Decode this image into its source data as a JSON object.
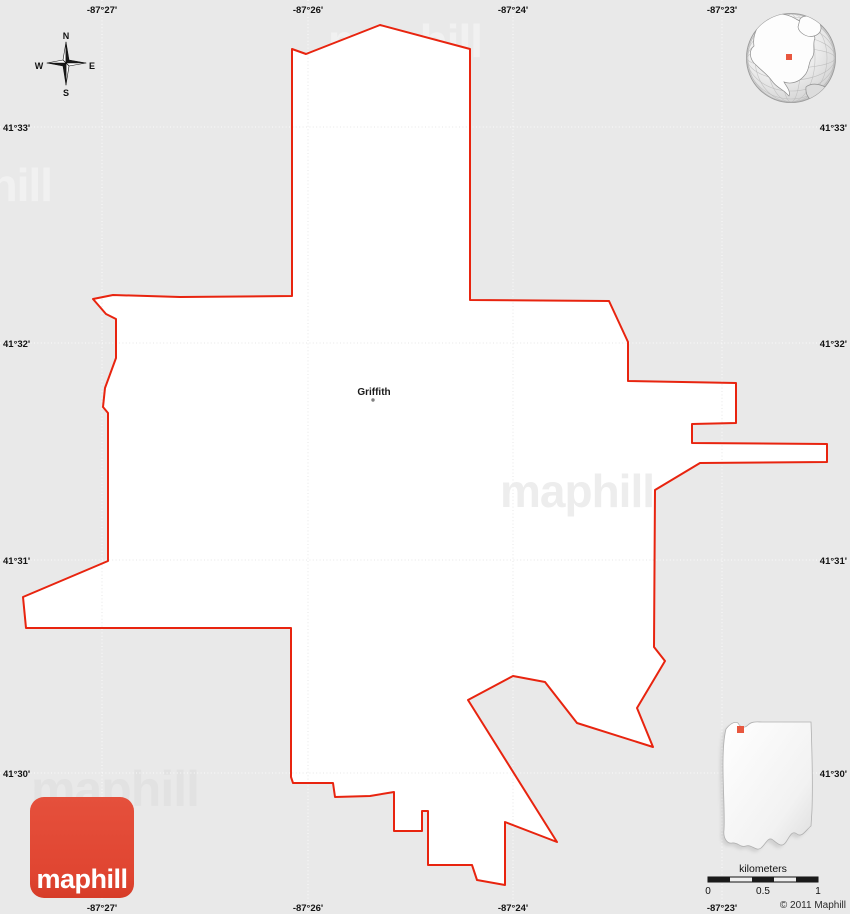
{
  "map": {
    "place_label": "Griffith",
    "boundary_points": "380,25 470,49 470,300 609,301 628,342 628,381 736,383 736,423 692,424 692,443 827,444 827,462 700,463 655,490 654,647 665,661 637,708 653,747 577,723 545,682 513,676 468,700 557,842 505,822 505,885 477,880 472,865 428,865 428,811 422,811 422,831 394,831 394,792 370,796 335,797 333,783 293,783 291,777 291,628 26,628 23,597 108,561 108,413 103,407 105,388 116,358 116,319 106,314 93,299 113,295 180,297 292,296 292,49 306,54",
    "colors": {
      "background": "#e9e9e9",
      "shape_fill": "#ffffff",
      "boundary_red": "#e8240f",
      "marker_red": "#e8573f",
      "logo_red": "#e04531"
    }
  },
  "grid": {
    "lon_labels": [
      "-87°27'",
      "-87°26'",
      "-87°24'",
      "-87°23'"
    ],
    "lat_labels": [
      "41°33'",
      "41°32'",
      "41°31'",
      "41°30'"
    ]
  },
  "compass": {
    "north": "N",
    "south": "S",
    "east": "E",
    "west": "W"
  },
  "watermark": {
    "text": "maphill"
  },
  "logo": {
    "text": "maphill"
  },
  "scale": {
    "title": "kilometers",
    "tick_0": "0",
    "tick_half": "0.5",
    "tick_1": "1"
  },
  "footer": {
    "copyright": "© 2011 Maphill"
  }
}
